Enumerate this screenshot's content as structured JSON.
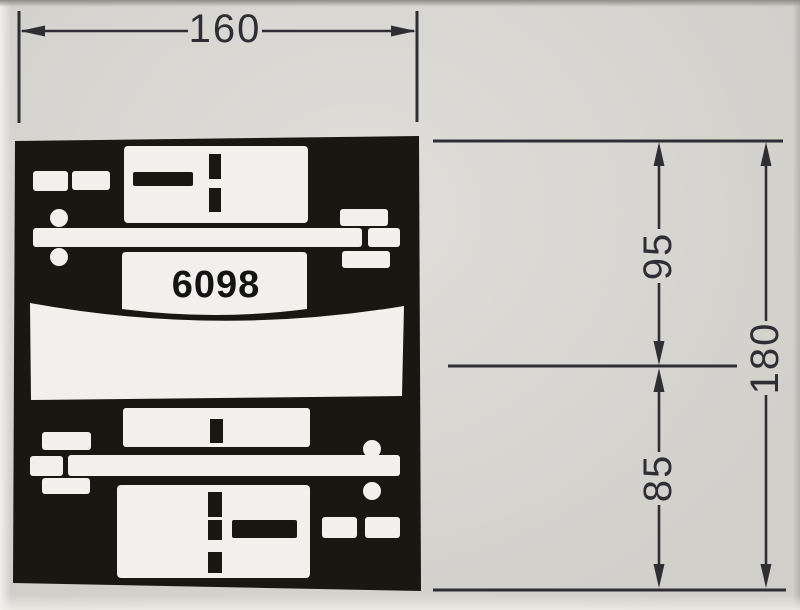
{
  "document": {
    "type_label": "scanned technical dimension drawing",
    "part": {
      "number": "6098"
    }
  },
  "colors": {
    "paper": "#d9d7d2",
    "paper_bright": "#f1f0ed",
    "paper_bottom": "#ebe9e4",
    "paper_top_edge": "#8f8d88",
    "paper_right_edge": "#b5b3ae",
    "ink": "#2e2e35",
    "plate_black": "#1a1713",
    "cutout_white": "#f2f0ec",
    "plate_text": "#141414"
  },
  "dimensions": {
    "width": {
      "label": "160",
      "orientation": "horizontal"
    },
    "upper_height": {
      "label": "95",
      "orientation": "vertical"
    },
    "lower_height": {
      "label": "85",
      "orientation": "vertical"
    },
    "total_height": {
      "label": "180",
      "orientation": "vertical"
    }
  }
}
